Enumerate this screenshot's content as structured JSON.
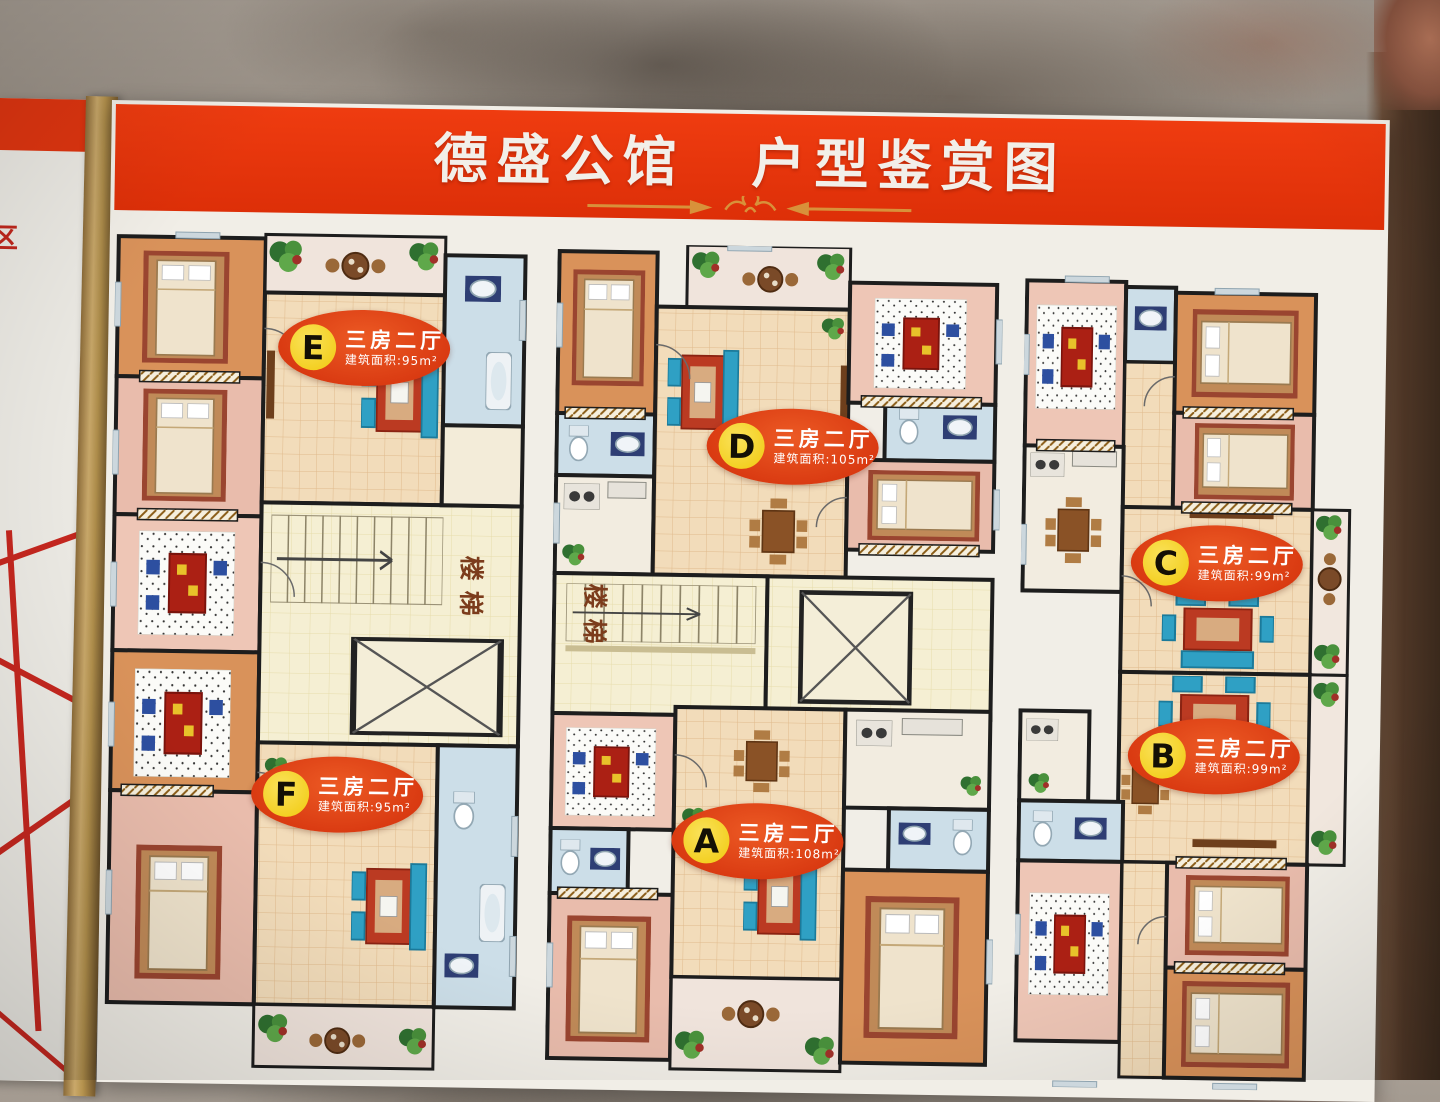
{
  "banner": {
    "title_left": "德盛公馆",
    "title_right": "户型鉴赏图"
  },
  "side_board": {
    "partial_text": "区"
  },
  "plan": {
    "stair_label": "楼梯"
  },
  "units": {
    "A": {
      "letter": "A",
      "type": "三房二厅",
      "area": "建筑面积:108m²"
    },
    "B": {
      "letter": "B",
      "type": "三房二厅",
      "area": "建筑面积:99m²"
    },
    "C": {
      "letter": "C",
      "type": "三房二厅",
      "area": "建筑面积:99m²"
    },
    "D": {
      "letter": "D",
      "type": "三房二厅",
      "area": "建筑面积:105m²"
    },
    "E": {
      "letter": "E",
      "type": "三房二厅",
      "area": "建筑面积:95m²"
    },
    "F": {
      "letter": "F",
      "type": "三房二厅",
      "area": "建筑面积:95m²"
    }
  },
  "colors": {
    "banner_red": "#e03410",
    "badge_orange": "#da3b12",
    "badge_yellow": "#f1c90e",
    "board_white": "#f1eee7"
  }
}
